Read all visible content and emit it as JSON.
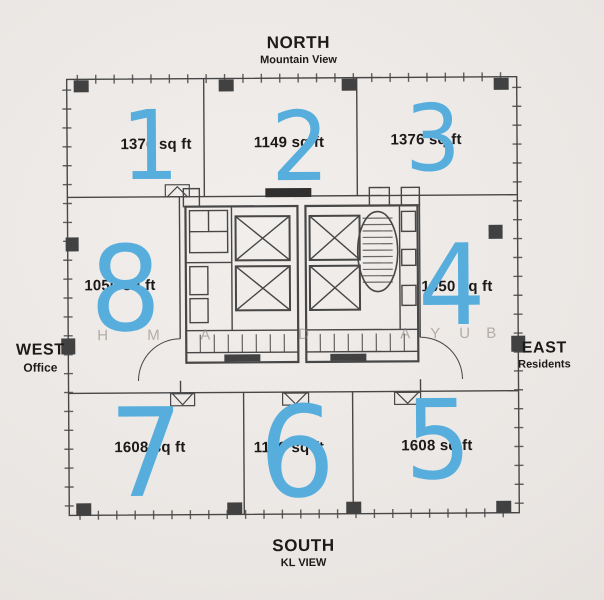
{
  "compass": {
    "north": {
      "label": "NORTH",
      "sublabel": "Mountain View"
    },
    "south": {
      "label": "SOUTH",
      "sublabel": "KL VIEW"
    },
    "west": {
      "label": "WEST",
      "sublabel": "Office"
    },
    "east": {
      "label": "EAST",
      "sublabel": "Residents"
    }
  },
  "units": [
    {
      "id": "1",
      "area": "1376 sq ft"
    },
    {
      "id": "2",
      "area": "1149 sq ft"
    },
    {
      "id": "3",
      "area": "1376 sq ft"
    },
    {
      "id": "4",
      "area": "1050 sq ft"
    },
    {
      "id": "5",
      "area": "1608 sq ft"
    },
    {
      "id": "6",
      "area": "1149 sq ft"
    },
    {
      "id": "7",
      "area": "1608 sq ft"
    },
    {
      "id": "8",
      "area": "1050 sq ft"
    }
  ],
  "watermark": {
    "letters": [
      "H",
      "M",
      "A",
      "D",
      "A",
      "Y",
      "U",
      "B"
    ]
  },
  "colors": {
    "unit_number_blue": "#57aedd",
    "plan_line": "#474747",
    "label_text": "#1c1a19",
    "paper": "#eae6e3"
  }
}
